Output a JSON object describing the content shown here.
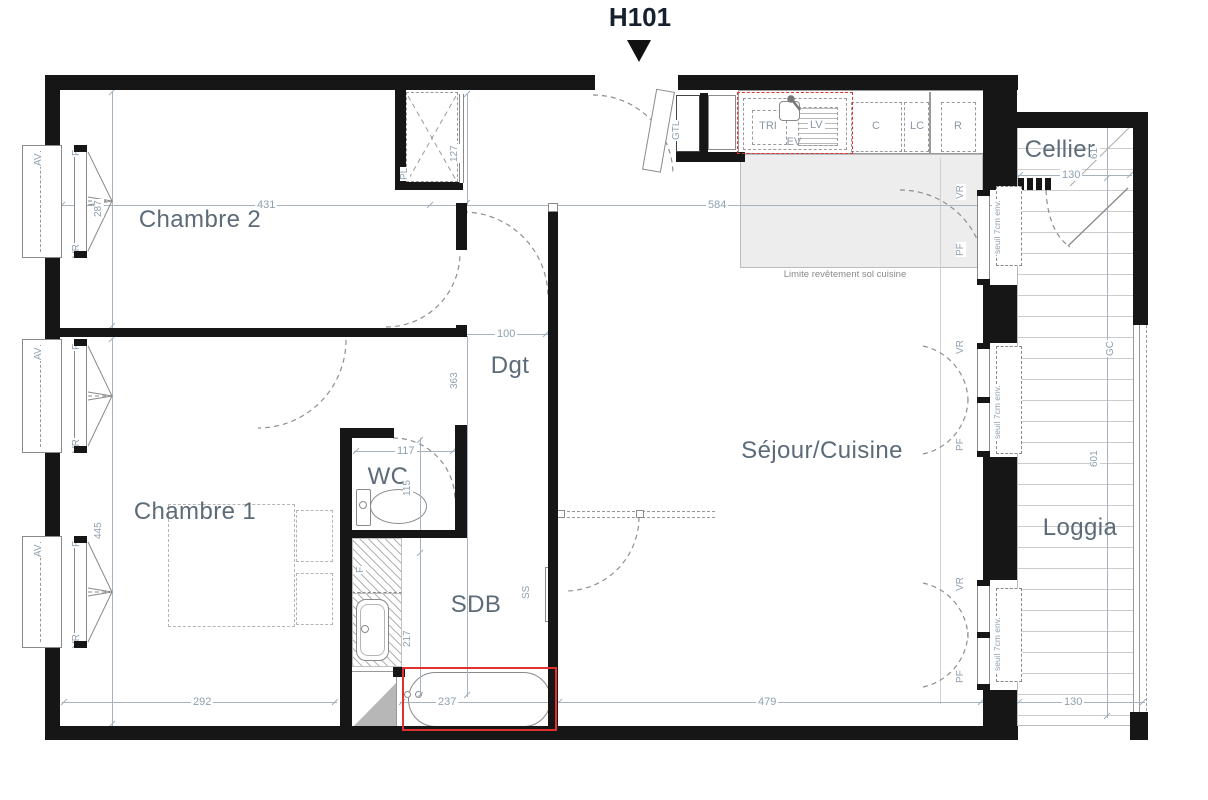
{
  "title": "H101",
  "rooms": {
    "chambre2": "Chambre 2",
    "chambre1": "Chambre 1",
    "dgt": "Dgt",
    "wc": "WC",
    "sdb": "SDB",
    "sejour": "Séjour/Cuisine",
    "cellier": "Cellier",
    "loggia": "Loggia"
  },
  "labels": {
    "av": "AV",
    "f_window": "F",
    "vr": "VR",
    "pf": "PF",
    "seuil": "seuil 7cm env.",
    "pl": "PL",
    "gtl": "GTL",
    "shaft": "F",
    "ss": "SS",
    "gc": "GC"
  },
  "kitchen": {
    "note": "Limite revêtement sol cuisine",
    "appliances": {
      "tri": "TRI",
      "ev": "EV",
      "lv": "LV",
      "c": "C",
      "lc": "LC",
      "r": "R"
    }
  },
  "dims": {
    "chambre2_w": "431",
    "sejour_w": "584",
    "chambre2_d": "287",
    "closet": "127",
    "dgt_w": "100",
    "dgt_d": "363",
    "wc_w": "117",
    "wc_d": "115",
    "sdb_d": "217",
    "chambre1_d": "445",
    "chambre1_w": "292",
    "bath": "237",
    "sejour_bottom": "479",
    "loggia_w": "130",
    "cellier_w": "130",
    "cellier_d": "61",
    "loggia_d": "601"
  },
  "colors": {
    "wall": "#161616",
    "accent_red": "#e03131",
    "room_label": "#5d6b79",
    "dim_text": "#8fa0af"
  }
}
